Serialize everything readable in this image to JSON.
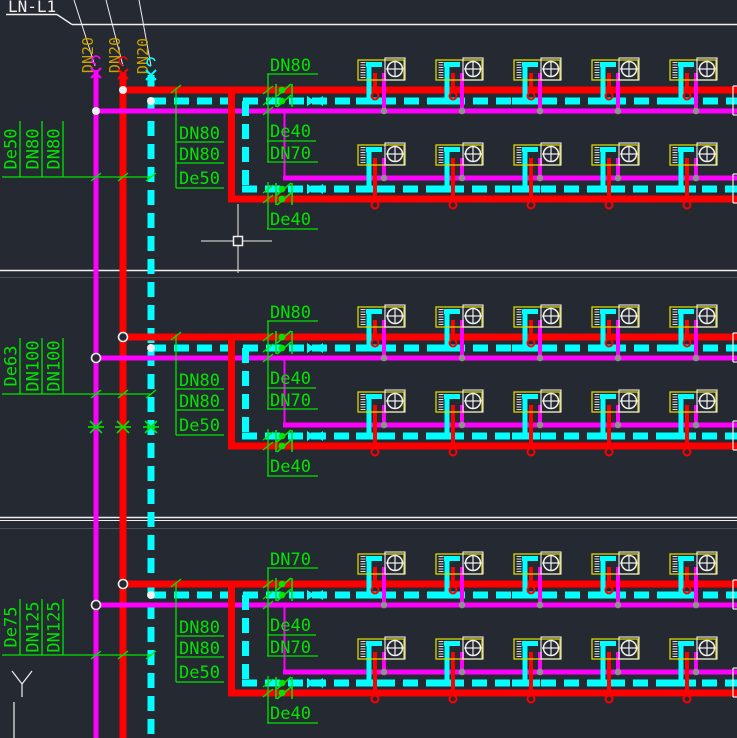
{
  "title_block": {
    "label": "LN-L1"
  },
  "risers": {
    "labels": [
      "DN20",
      "DN20",
      "DN20"
    ],
    "pipes": [
      "chilled-water-supply",
      "chilled-water-return",
      "condensate"
    ]
  },
  "bands": [
    {
      "left_stack": [
        "De50",
        "DN80",
        "DN80"
      ],
      "top_label": "DN80",
      "mid_left_stack": [
        "DN80",
        "DN80",
        "De50"
      ],
      "mid_right_stack": [
        "De40",
        "DN70"
      ],
      "bottom_label": "De40",
      "junction_style": "filled",
      "has_asterisks": false
    },
    {
      "left_stack": [
        "De63",
        "DN100",
        "DN100"
      ],
      "top_label": "DN80",
      "mid_left_stack": [
        "DN80",
        "DN80",
        "De50"
      ],
      "mid_right_stack": [
        "De40",
        "DN70"
      ],
      "bottom_label": "De40",
      "junction_style": "open",
      "has_asterisks": true
    },
    {
      "left_stack": [
        "De75",
        "DN125",
        "DN125"
      ],
      "top_label": "DN70",
      "mid_left_stack": [
        "DN80",
        "DN80",
        "De50"
      ],
      "mid_right_stack": [
        "De40",
        "DN70"
      ],
      "bottom_label": "De40",
      "junction_style": "open",
      "has_asterisks": false
    }
  ],
  "units_per_row": 5,
  "rows_per_band": 2,
  "cursor": {
    "x": 238,
    "y": 241
  },
  "colors": {
    "background": "#252931",
    "supply_red": "#ff0000",
    "condensate_cyan": "#00ffff",
    "return_magenta": "#ff00ff",
    "label_green": "#00e400",
    "riser_label_gold": "#c9a000",
    "white": "#f0f0f0",
    "dim_line": "#4a4f57",
    "unit_box_yellow": "#d8d800",
    "connector_gray": "#909090"
  }
}
